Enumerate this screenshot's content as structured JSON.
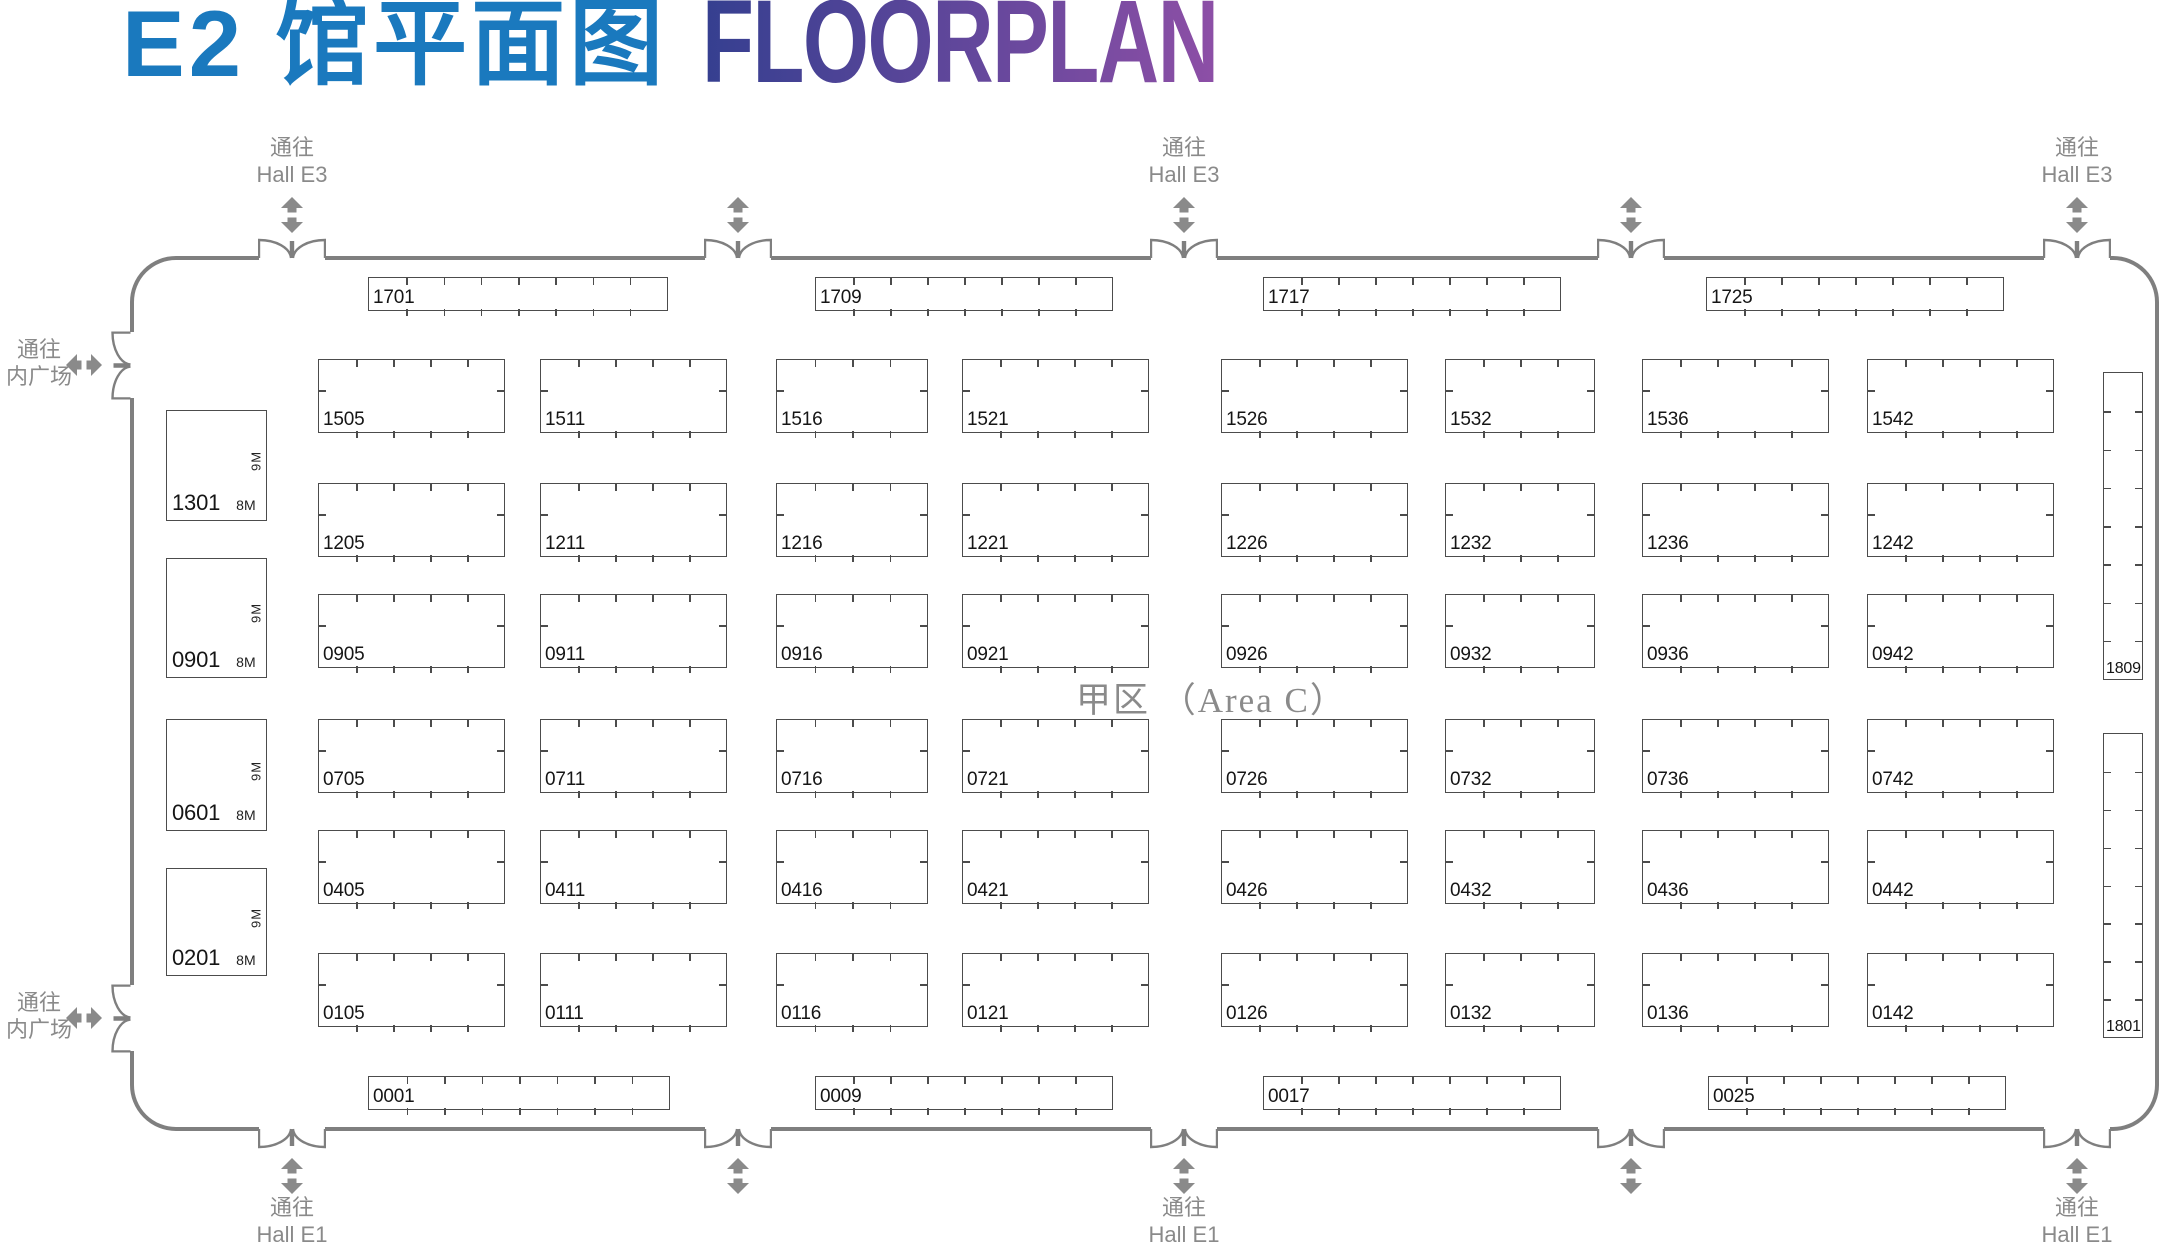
{
  "title": {
    "zh": "E2 馆平面图",
    "en": "FLOORPLAN"
  },
  "colors": {
    "title_blue": "#1a79be",
    "title_gradient_start": "#353f90",
    "title_gradient_end": "#8d4fa6",
    "wall": "#7f7f7f",
    "passage_gray": "#8a8a8a",
    "booth_border": "#4c4c4c",
    "booth_text": "#151515",
    "area_text": "#8a8a8a"
  },
  "area_label": "甲区 （Area C）",
  "hall": {
    "x": 130,
    "y": 256,
    "w": 2029,
    "h": 875,
    "corner_radius": 46
  },
  "passages": {
    "top": {
      "label_lines": [
        "通往",
        "Hall E3"
      ],
      "doors": [
        {
          "cx": 292,
          "labeled": true
        },
        {
          "cx": 738,
          "labeled": false
        },
        {
          "cx": 1184,
          "labeled": true
        },
        {
          "cx": 1631,
          "labeled": false
        },
        {
          "cx": 2077,
          "labeled": true
        }
      ]
    },
    "bottom": {
      "label_lines": [
        "通往",
        "Hall E1"
      ],
      "doors": [
        {
          "cx": 292,
          "labeled": true
        },
        {
          "cx": 738,
          "labeled": false
        },
        {
          "cx": 1184,
          "labeled": true
        },
        {
          "cx": 1631,
          "labeled": false
        },
        {
          "cx": 2077,
          "labeled": true
        }
      ]
    },
    "left": {
      "label_lines": [
        "通往",
        "内广场"
      ],
      "doors": [
        {
          "cy": 365,
          "labeled": true
        },
        {
          "cy": 1018,
          "labeled": true
        }
      ]
    }
  },
  "booths": [
    {
      "id": "1701",
      "x": 368,
      "y": 277,
      "w": 300,
      "h": 34,
      "t": [
        7,
        7,
        0,
        0
      ]
    },
    {
      "id": "1709",
      "x": 815,
      "y": 277,
      "w": 298,
      "h": 34,
      "t": [
        7,
        7,
        0,
        0
      ]
    },
    {
      "id": "1717",
      "x": 1263,
      "y": 277,
      "w": 298,
      "h": 34,
      "t": [
        7,
        7,
        0,
        0
      ]
    },
    {
      "id": "1725",
      "x": 1706,
      "y": 277,
      "w": 298,
      "h": 34,
      "t": [
        7,
        7,
        0,
        0
      ]
    },
    {
      "id": "1505",
      "x": 318,
      "y": 359,
      "w": 187,
      "h": 74,
      "t": [
        4,
        4,
        1,
        1
      ]
    },
    {
      "id": "1511",
      "x": 540,
      "y": 359,
      "w": 187,
      "h": 74,
      "t": [
        4,
        4,
        1,
        1
      ]
    },
    {
      "id": "1516",
      "x": 776,
      "y": 359,
      "w": 152,
      "h": 74,
      "t": [
        3,
        3,
        1,
        1
      ]
    },
    {
      "id": "1521",
      "x": 962,
      "y": 359,
      "w": 187,
      "h": 74,
      "t": [
        4,
        4,
        1,
        1
      ]
    },
    {
      "id": "1526",
      "x": 1221,
      "y": 359,
      "w": 187,
      "h": 74,
      "t": [
        4,
        4,
        1,
        1
      ]
    },
    {
      "id": "1532",
      "x": 1445,
      "y": 359,
      "w": 150,
      "h": 74,
      "t": [
        3,
        3,
        1,
        1
      ]
    },
    {
      "id": "1536",
      "x": 1642,
      "y": 359,
      "w": 187,
      "h": 74,
      "t": [
        4,
        4,
        1,
        1
      ]
    },
    {
      "id": "1542",
      "x": 1867,
      "y": 359,
      "w": 187,
      "h": 74,
      "t": [
        4,
        4,
        1,
        1
      ]
    },
    {
      "id": "1205",
      "x": 318,
      "y": 483,
      "w": 187,
      "h": 74,
      "t": [
        4,
        4,
        1,
        1
      ]
    },
    {
      "id": "1211",
      "x": 540,
      "y": 483,
      "w": 187,
      "h": 74,
      "t": [
        4,
        4,
        1,
        1
      ]
    },
    {
      "id": "1216",
      "x": 776,
      "y": 483,
      "w": 152,
      "h": 74,
      "t": [
        3,
        3,
        1,
        1
      ]
    },
    {
      "id": "1221",
      "x": 962,
      "y": 483,
      "w": 187,
      "h": 74,
      "t": [
        4,
        4,
        1,
        1
      ]
    },
    {
      "id": "1226",
      "x": 1221,
      "y": 483,
      "w": 187,
      "h": 74,
      "t": [
        4,
        4,
        1,
        1
      ]
    },
    {
      "id": "1232",
      "x": 1445,
      "y": 483,
      "w": 150,
      "h": 74,
      "t": [
        3,
        3,
        1,
        1
      ]
    },
    {
      "id": "1236",
      "x": 1642,
      "y": 483,
      "w": 187,
      "h": 74,
      "t": [
        4,
        4,
        1,
        1
      ]
    },
    {
      "id": "1242",
      "x": 1867,
      "y": 483,
      "w": 187,
      "h": 74,
      "t": [
        4,
        4,
        1,
        1
      ]
    },
    {
      "id": "0905",
      "x": 318,
      "y": 594,
      "w": 187,
      "h": 74,
      "t": [
        4,
        4,
        1,
        1
      ]
    },
    {
      "id": "0911",
      "x": 540,
      "y": 594,
      "w": 187,
      "h": 74,
      "t": [
        4,
        4,
        1,
        1
      ]
    },
    {
      "id": "0916",
      "x": 776,
      "y": 594,
      "w": 152,
      "h": 74,
      "t": [
        3,
        3,
        1,
        1
      ]
    },
    {
      "id": "0921",
      "x": 962,
      "y": 594,
      "w": 187,
      "h": 74,
      "t": [
        4,
        4,
        1,
        1
      ]
    },
    {
      "id": "0926",
      "x": 1221,
      "y": 594,
      "w": 187,
      "h": 74,
      "t": [
        4,
        4,
        1,
        1
      ]
    },
    {
      "id": "0932",
      "x": 1445,
      "y": 594,
      "w": 150,
      "h": 74,
      "t": [
        3,
        3,
        1,
        1
      ]
    },
    {
      "id": "0936",
      "x": 1642,
      "y": 594,
      "w": 187,
      "h": 74,
      "t": [
        4,
        4,
        1,
        1
      ]
    },
    {
      "id": "0942",
      "x": 1867,
      "y": 594,
      "w": 187,
      "h": 74,
      "t": [
        4,
        4,
        1,
        1
      ]
    },
    {
      "id": "0705",
      "x": 318,
      "y": 719,
      "w": 187,
      "h": 74,
      "t": [
        4,
        4,
        1,
        1
      ]
    },
    {
      "id": "0711",
      "x": 540,
      "y": 719,
      "w": 187,
      "h": 74,
      "t": [
        4,
        4,
        1,
        1
      ]
    },
    {
      "id": "0716",
      "x": 776,
      "y": 719,
      "w": 152,
      "h": 74,
      "t": [
        3,
        3,
        1,
        1
      ]
    },
    {
      "id": "0721",
      "x": 962,
      "y": 719,
      "w": 187,
      "h": 74,
      "t": [
        4,
        4,
        1,
        1
      ]
    },
    {
      "id": "0726",
      "x": 1221,
      "y": 719,
      "w": 187,
      "h": 74,
      "t": [
        4,
        4,
        1,
        1
      ]
    },
    {
      "id": "0732",
      "x": 1445,
      "y": 719,
      "w": 150,
      "h": 74,
      "t": [
        3,
        3,
        1,
        1
      ]
    },
    {
      "id": "0736",
      "x": 1642,
      "y": 719,
      "w": 187,
      "h": 74,
      "t": [
        4,
        4,
        1,
        1
      ]
    },
    {
      "id": "0742",
      "x": 1867,
      "y": 719,
      "w": 187,
      "h": 74,
      "t": [
        4,
        4,
        1,
        1
      ]
    },
    {
      "id": "0405",
      "x": 318,
      "y": 830,
      "w": 187,
      "h": 74,
      "t": [
        4,
        4,
        1,
        1
      ]
    },
    {
      "id": "0411",
      "x": 540,
      "y": 830,
      "w": 187,
      "h": 74,
      "t": [
        4,
        4,
        1,
        1
      ]
    },
    {
      "id": "0416",
      "x": 776,
      "y": 830,
      "w": 152,
      "h": 74,
      "t": [
        3,
        3,
        1,
        1
      ]
    },
    {
      "id": "0421",
      "x": 962,
      "y": 830,
      "w": 187,
      "h": 74,
      "t": [
        4,
        4,
        1,
        1
      ]
    },
    {
      "id": "0426",
      "x": 1221,
      "y": 830,
      "w": 187,
      "h": 74,
      "t": [
        4,
        4,
        1,
        1
      ]
    },
    {
      "id": "0432",
      "x": 1445,
      "y": 830,
      "w": 150,
      "h": 74,
      "t": [
        3,
        3,
        1,
        1
      ]
    },
    {
      "id": "0436",
      "x": 1642,
      "y": 830,
      "w": 187,
      "h": 74,
      "t": [
        4,
        4,
        1,
        1
      ]
    },
    {
      "id": "0442",
      "x": 1867,
      "y": 830,
      "w": 187,
      "h": 74,
      "t": [
        4,
        4,
        1,
        1
      ]
    },
    {
      "id": "0105",
      "x": 318,
      "y": 953,
      "w": 187,
      "h": 74,
      "t": [
        4,
        4,
        1,
        1
      ]
    },
    {
      "id": "0111",
      "x": 540,
      "y": 953,
      "w": 187,
      "h": 74,
      "t": [
        4,
        4,
        1,
        1
      ]
    },
    {
      "id": "0116",
      "x": 776,
      "y": 953,
      "w": 152,
      "h": 74,
      "t": [
        3,
        3,
        1,
        1
      ]
    },
    {
      "id": "0121",
      "x": 962,
      "y": 953,
      "w": 187,
      "h": 74,
      "t": [
        4,
        4,
        1,
        1
      ]
    },
    {
      "id": "0126",
      "x": 1221,
      "y": 953,
      "w": 187,
      "h": 74,
      "t": [
        4,
        4,
        1,
        1
      ]
    },
    {
      "id": "0132",
      "x": 1445,
      "y": 953,
      "w": 150,
      "h": 74,
      "t": [
        3,
        3,
        1,
        1
      ]
    },
    {
      "id": "0136",
      "x": 1642,
      "y": 953,
      "w": 187,
      "h": 74,
      "t": [
        4,
        4,
        1,
        1
      ]
    },
    {
      "id": "0142",
      "x": 1867,
      "y": 953,
      "w": 187,
      "h": 74,
      "t": [
        4,
        4,
        1,
        1
      ]
    },
    {
      "id": "1301",
      "x": 166,
      "y": 410,
      "w": 101,
      "h": 111,
      "t": [
        0,
        0,
        0,
        0
      ],
      "side": "8M",
      "depth": "9M"
    },
    {
      "id": "0901",
      "x": 166,
      "y": 558,
      "w": 101,
      "h": 120,
      "t": [
        0,
        0,
        0,
        0
      ],
      "side": "8M",
      "depth": "9M"
    },
    {
      "id": "0601",
      "x": 166,
      "y": 719,
      "w": 101,
      "h": 112,
      "t": [
        0,
        0,
        0,
        0
      ],
      "side": "8M",
      "depth": "9M"
    },
    {
      "id": "0201",
      "x": 166,
      "y": 868,
      "w": 101,
      "h": 108,
      "t": [
        0,
        0,
        0,
        0
      ],
      "side": "8M",
      "depth": "9M"
    },
    {
      "id": "1809",
      "x": 2103,
      "y": 372,
      "w": 40,
      "h": 308,
      "t": [
        0,
        0,
        7,
        7
      ]
    },
    {
      "id": "1801",
      "x": 2103,
      "y": 733,
      "w": 40,
      "h": 305,
      "t": [
        0,
        0,
        7,
        7
      ]
    },
    {
      "id": "0001",
      "x": 368,
      "y": 1076,
      "w": 302,
      "h": 34,
      "t": [
        7,
        7,
        0,
        0
      ]
    },
    {
      "id": "0009",
      "x": 815,
      "y": 1076,
      "w": 298,
      "h": 34,
      "t": [
        7,
        7,
        0,
        0
      ]
    },
    {
      "id": "0017",
      "x": 1263,
      "y": 1076,
      "w": 298,
      "h": 34,
      "t": [
        7,
        7,
        0,
        0
      ]
    },
    {
      "id": "0025",
      "x": 1708,
      "y": 1076,
      "w": 298,
      "h": 34,
      "t": [
        7,
        7,
        0,
        0
      ]
    }
  ]
}
